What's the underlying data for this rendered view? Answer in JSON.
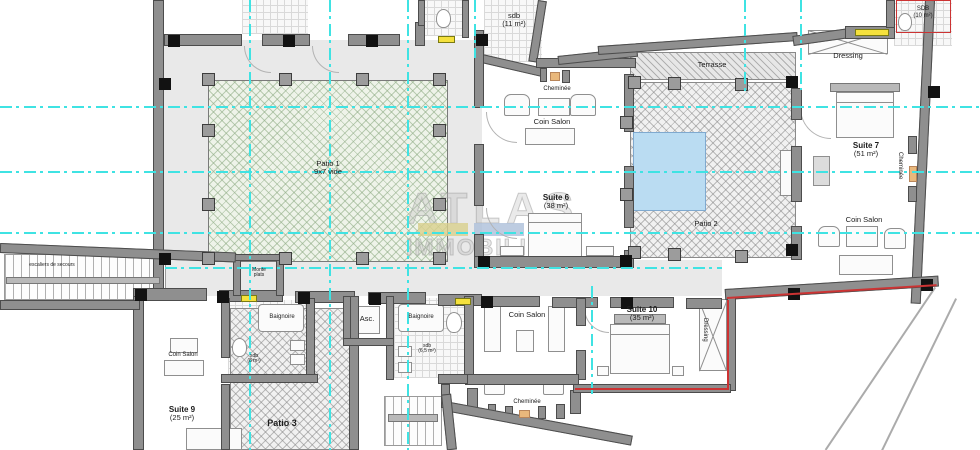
{
  "plan": {
    "watermark": {
      "brand_top": "ATLAS",
      "brand_bottom": "IMMOBILIER"
    },
    "labels": {
      "patio1_name": "Patio 1",
      "patio1_detail": "9x7 vide",
      "sdb11_name": "sdb",
      "sdb11_area": "(11 m²)",
      "cheminee_top": "Cheminée",
      "coin_salon_top": "Coin Salon",
      "suite6_name": "Suite 6",
      "suite6_area": "(38 m²)",
      "terrasse": "Terrasse",
      "patio2": "Patio 2",
      "sdb10_name": "SDB",
      "sdb10_area": "(10 m²)",
      "dressing_top": "Dressing",
      "suite7_name": "Suite 7",
      "suite7_area": "(51 m²)",
      "cheminee_right": "Cheminée",
      "coin_salon_right": "Coin Salon",
      "coin_salon_bottom": "Coin Salon",
      "suite10_name": "Suite 10",
      "suite10_area": "(35 m²)",
      "dressing_bottom": "Dressing",
      "cheminee_bottom": "Cheminée",
      "asc": "Asc.",
      "baignoire_left": "Baignoire",
      "baignoire_center": "Baignoire",
      "sdb8_name": "sdb",
      "sdb8_area": "(8 m²)",
      "sdb65_name": "sdb",
      "sdb65_area": "(6,5 m²)",
      "coin_salon_suite9": "Coin Salon",
      "suite9_name": "Suite 9",
      "suite9_area": "(25 m²)",
      "patio3": "Patio 3",
      "monte_plats": "Monte plats",
      "escalier": "escaliers de secours"
    },
    "colors": {
      "gridline_cyan": "#3fe3e3",
      "wall_gray": "#8f8f8f",
      "column_black": "#121212",
      "patio1_hatch_green": "#8caa82",
      "patio_gray_hatch": "#828282",
      "pool_blue": "#badcf2",
      "hall_floor": "#e9e9e9",
      "boundary_red": "#cc3333",
      "window_yellow": "#f5e13d",
      "fireplace_orange": "#e9b87c",
      "watermark_bar_yellow": "#d8cf8c",
      "watermark_bar_blue": "#adbfd9",
      "watermark_bar_red": "#da9e9e"
    }
  }
}
